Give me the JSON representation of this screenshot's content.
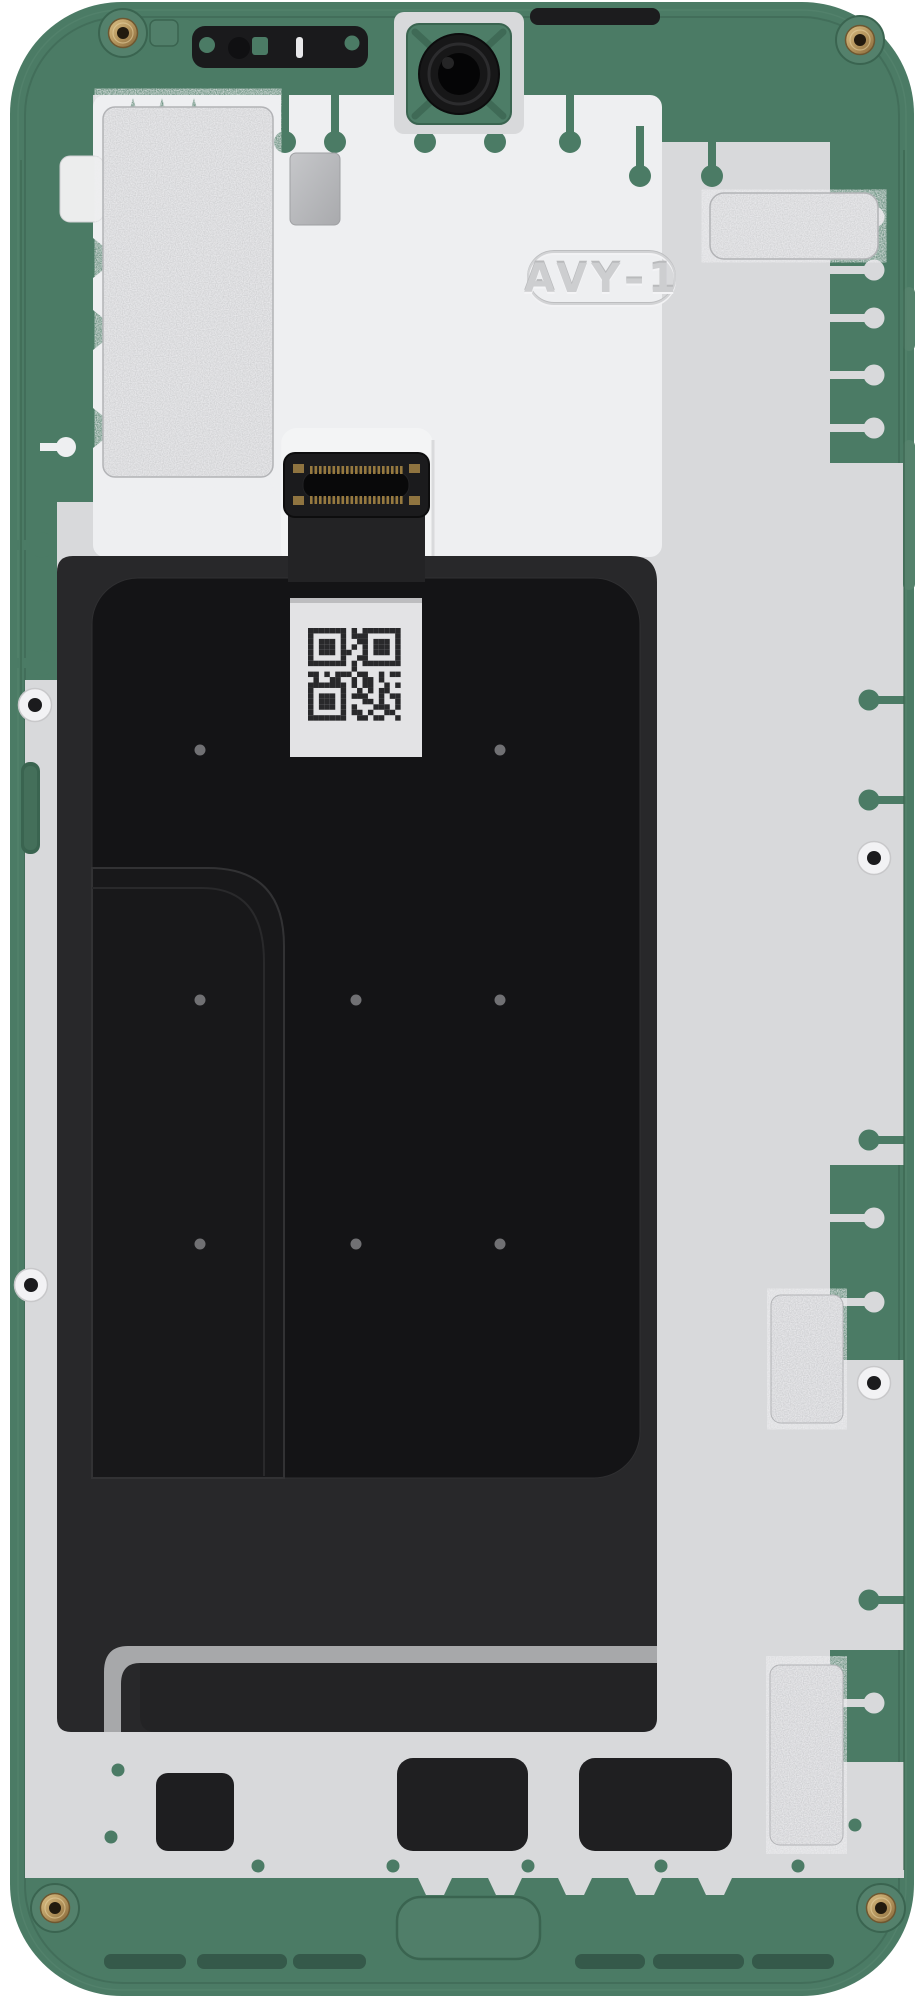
{
  "marking": {
    "text": "AVY–1"
  },
  "colors": {
    "frame_green": "#4b7b65",
    "frame_green_dark": "#3a6450",
    "frame_green_deep": "#35594a",
    "frame_green_light": "#55826c",
    "plate_gray": "#d8d9db",
    "plate_bright": "#eeeff1",
    "pedestal_white": "#f3f4f5",
    "graphite_dark": "#28282a",
    "graphite_sheet": "#141416",
    "metal_stripe": "#a7a8aa",
    "gold": "#b5965e",
    "gold_deep": "#8a6f3e",
    "sticker_silver": "#c9cacc",
    "metal_square": "#b8b9bc",
    "label_white": "#e3e3e5",
    "qr_dark": "#29292b",
    "screw_hole_dark": "#1b1b1d",
    "emboss_gray": "#cdced0"
  },
  "qr": {
    "pattern": [
      "#######.#.#######",
      "#.....#.###.....#",
      "#.###.#..##.###.#",
      "#.###.#.#.#.###.#",
      "#.###.##..#.###.#",
      "#.....#..##.....#",
      "#######.#.#######",
      "........#........",
      "##.#.###.##..#.##",
      ".#..##..#.##.#...",
      "#######.#.##..#.#",
      "#.....#..#.#.##..",
      "#.###.#.###..#.##",
      "#.###.#...##.#..#",
      "#.###.#.#...###.#",
      "#.....#.##.#..##.",
      "#######..##.##..#"
    ]
  }
}
